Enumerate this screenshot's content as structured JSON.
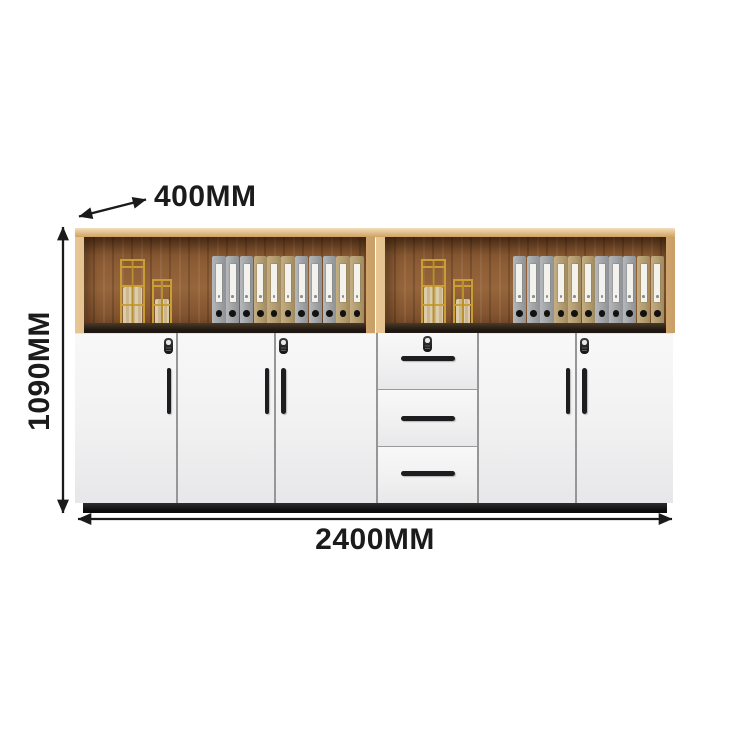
{
  "dimensions": {
    "depth_label": "400MM",
    "height_label": "1090MM",
    "width_label": "2400MM"
  },
  "cabinet": {
    "colors": {
      "annotation": "#1b1b1b",
      "wood_frame": "#dcb681",
      "interior_wood": "#8a5a33",
      "door_white": "#f3f3f4",
      "plinth": "#2e2e2e",
      "hardware": "#1d1d1f",
      "basket_gold": "#c89e35",
      "binder_gray": "#9da1a4",
      "binder_tan": "#b09a6e"
    },
    "upper": {
      "compartment_count": 2,
      "compartments": [
        {
          "baskets": 2,
          "binder_pattern": [
            "gray",
            "gray",
            "gray",
            "tan",
            "tan",
            "tan",
            "gray",
            "gray",
            "gray",
            "tan",
            "tan"
          ]
        },
        {
          "baskets": 2,
          "binder_pattern": [
            "gray",
            "gray",
            "gray",
            "tan",
            "tan",
            "tan",
            "gray",
            "gray",
            "gray",
            "tan",
            "tan"
          ]
        }
      ]
    },
    "lower": {
      "left_door_count": 3,
      "drawer_count": 3,
      "right_door_count": 2,
      "locks_on": [
        "left-door-1",
        "left-door-3",
        "drawer-1",
        "right-door-2"
      ]
    }
  }
}
